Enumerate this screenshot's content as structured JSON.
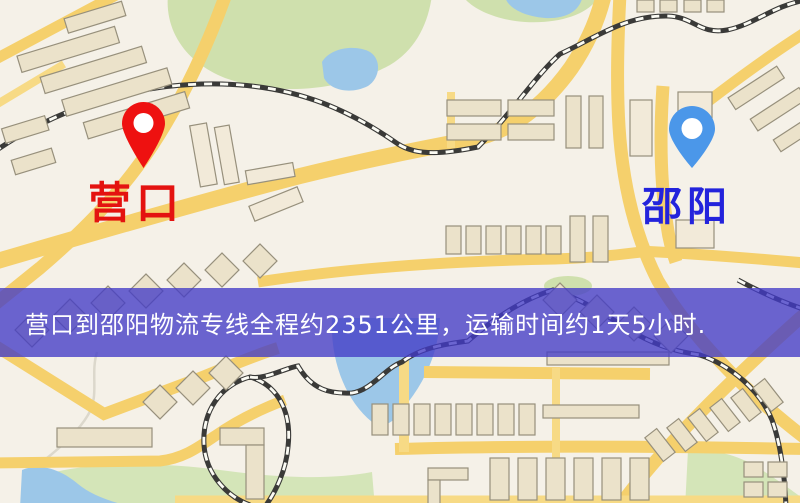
{
  "window": {
    "width": 800,
    "height": 503,
    "type": "logistics-route-map"
  },
  "banner": {
    "text": "营口到邵阳物流专线全程约2351公里，运输时间约1天5小时.",
    "background": "#423BC7",
    "background_opacity": 0.78,
    "text_color": "#FFFFFF"
  },
  "markers": {
    "origin": {
      "label": "营口",
      "label_color": "#E41310",
      "pin_color": "#EE1110",
      "pin_hole_color": "#FFFFFF"
    },
    "destination": {
      "label": "邵阳",
      "label_color": "#2323DC",
      "pin_color": "#4B97E9",
      "pin_hole_color": "#FFFFFF"
    }
  },
  "map": {
    "style": "street-map",
    "colors": {
      "background": "#F5F1E8",
      "road": "#F5D06C",
      "building": "#EBE2CA",
      "park": "#CFE0AD",
      "water": "#9CC7E8",
      "railway_dark": "#3A3A38",
      "railway_light": "#FBFBF4"
    }
  }
}
